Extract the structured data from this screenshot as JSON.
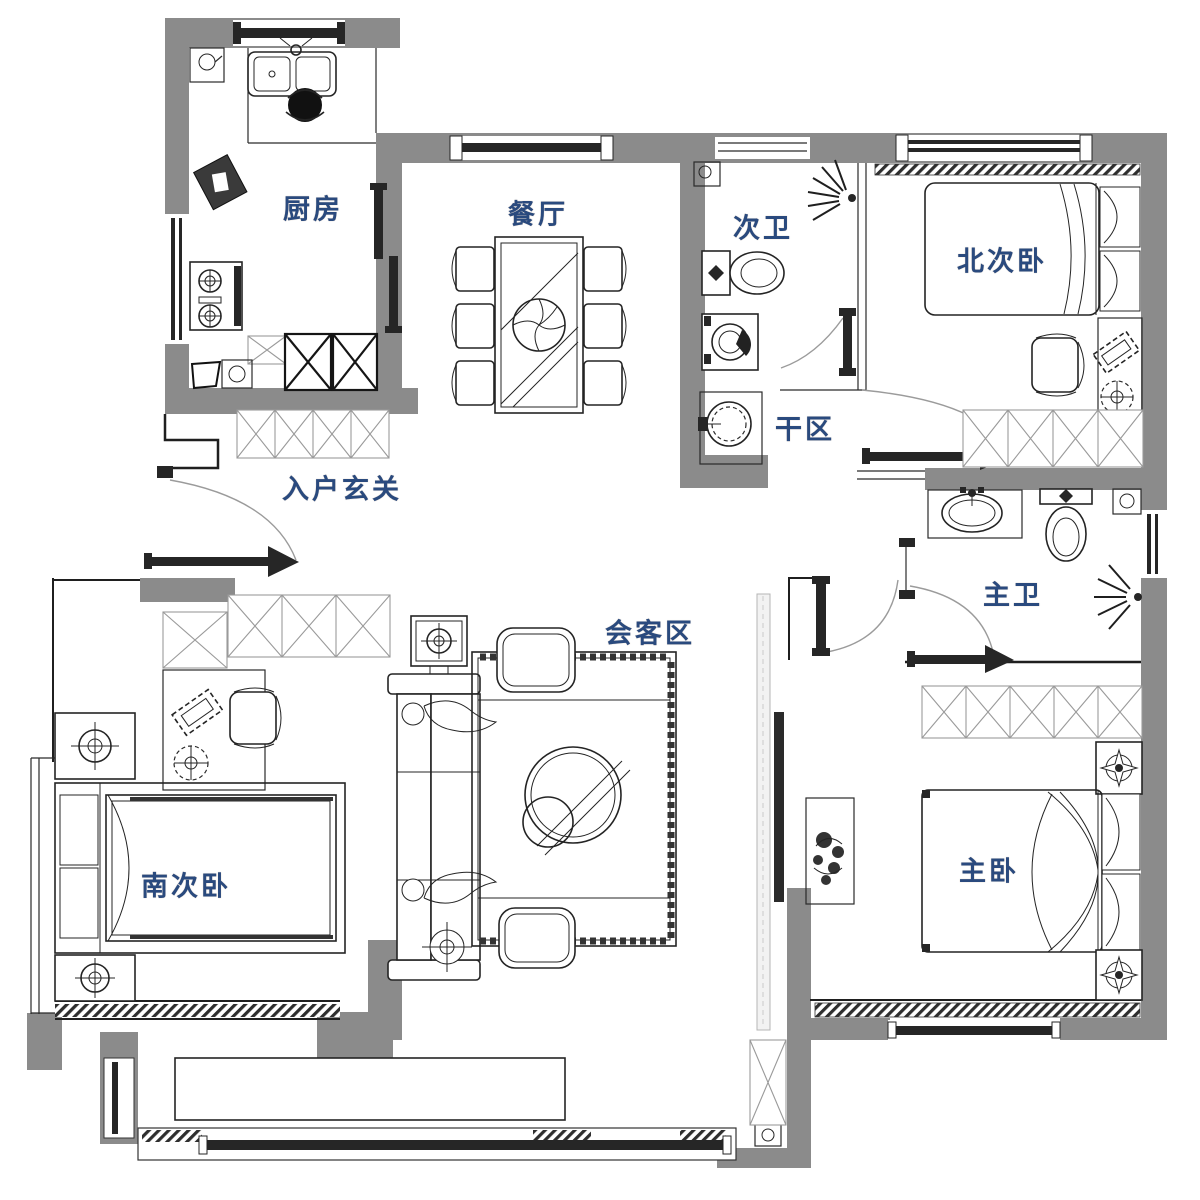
{
  "plan": {
    "type": "apartment-floor-plan",
    "colors": {
      "wall_gray": "#8b8b8b",
      "line_black": "#1f1f1f",
      "label_navy": "#2a4a7e",
      "background": "#ffffff"
    },
    "rooms": {
      "kitchen": {
        "label": "厨房"
      },
      "dining": {
        "label": "餐厅"
      },
      "secondary_bath": {
        "label": "次卫"
      },
      "north_bedroom": {
        "label": "北次卧"
      },
      "dry_area": {
        "label": "干区"
      },
      "entry_foyer": {
        "label": "入户玄关"
      },
      "master_bath": {
        "label": "主卫"
      },
      "living_area": {
        "label": "会客区"
      },
      "south_bedroom": {
        "label": "南次卧"
      },
      "master_bedroom": {
        "label": "主卧"
      }
    }
  }
}
